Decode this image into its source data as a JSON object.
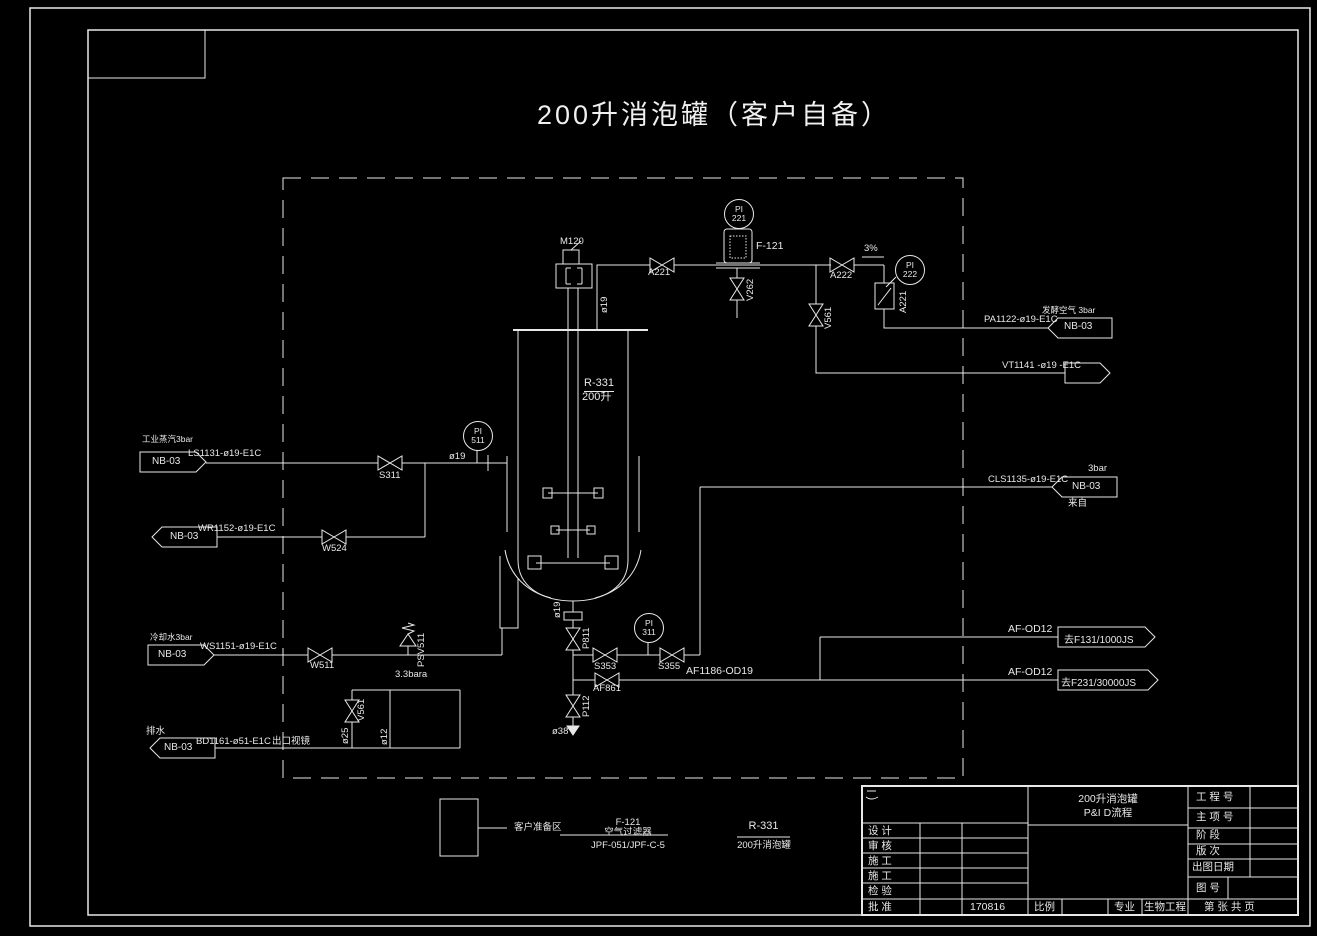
{
  "colors": {
    "background": "#000000",
    "ink": "#e8e8e8"
  },
  "title": {
    "text": "200升消泡罐（客户自备）"
  },
  "equipment": {
    "tank_tag": "R-331",
    "tank_capacity": "200升",
    "motor_tag": "M120",
    "filter_tag": "F-121"
  },
  "instruments": {
    "pi221": {
      "func": "PI",
      "tag": "221"
    },
    "pi222": {
      "func": "PI",
      "tag": "222"
    },
    "pi511": {
      "func": "PI",
      "tag": "511"
    },
    "pi311": {
      "func": "PI",
      "tag": "311"
    }
  },
  "valves": {
    "a221": "A221",
    "v262": "V262",
    "a222": "A222",
    "rotameter": "A221",
    "v561_air": "V561",
    "s311": "S311",
    "w524": "W524",
    "w511": "W511",
    "psv511": "PSV511",
    "v561_drain": "V561",
    "s353": "S353",
    "s355": "S355",
    "af861": "AF861",
    "p811": "P811",
    "p112": "P112"
  },
  "annotations": {
    "slope": "3%",
    "psv_setpoint": "3.3bara",
    "top_size": "ø19",
    "steam_size": "ø19",
    "drain_size1": "ø25",
    "drain_size2": "ø12",
    "bottom_size": "ø19",
    "outlet_size": "ø38"
  },
  "streams": {
    "steam": {
      "service": "工业蒸汽3bar",
      "connector": "NB-03",
      "line": "LS1131-ø19-E1C"
    },
    "condensate": {
      "connector": "NB-03",
      "line": "WR1152-ø19-E1C"
    },
    "cooling": {
      "service": "冷却水3bar",
      "connector": "NB-03",
      "line": "WS1151-ø19-E1C"
    },
    "drain": {
      "service": "排水",
      "connector": "NB-03",
      "line": "BD1161-ø51-E1C",
      "note": "出口视镜"
    },
    "air_out": {
      "service": "发酵空气 3bar",
      "connector": "NB-03",
      "line": "PA1122-ø19-E1C"
    },
    "vent": {
      "line": "VT1141 -ø19 -E1C"
    },
    "antifoam_supply": {
      "line": "CLS1135-ø19-E1C",
      "pressure": "3bar",
      "connector": "NB-03",
      "origin": "来自"
    },
    "antifoam_header": {
      "line": "AF1186-OD19"
    },
    "antifoam_f131": {
      "line": "AF-OD12",
      "dest": "去F131/1000JS"
    },
    "antifoam_f231": {
      "line": "AF-OD12",
      "dest": "去F231/30000JS"
    }
  },
  "legend": {
    "area": "客户准备区",
    "filter_tag": "F-121",
    "filter_name": "空气过滤器",
    "filter_model": "JPF-051/JPF-C-5",
    "tank_tag": "R-331",
    "tank_name": "200升消泡罐"
  },
  "titleblock": {
    "title_line1": "200升消泡罐",
    "title_line2": "P&I D流程",
    "project_label": "工 程 号",
    "item_label": "主 项 号",
    "stage_label": "阶    段",
    "rev_label": "版    次",
    "date_label": "出图日期",
    "dwgno_label": "图 号",
    "design_label": "设 计",
    "check_label": "审 核",
    "constr1_label": "施 工",
    "constr2_label": "施 工",
    "inspect_label": "检 验",
    "approve_label": "批 准",
    "approve_value": "170816",
    "scale_label": "比例",
    "discipline_label": "专业",
    "discipline_value": "生物工程",
    "sheet_label": "第  张 共  页"
  }
}
